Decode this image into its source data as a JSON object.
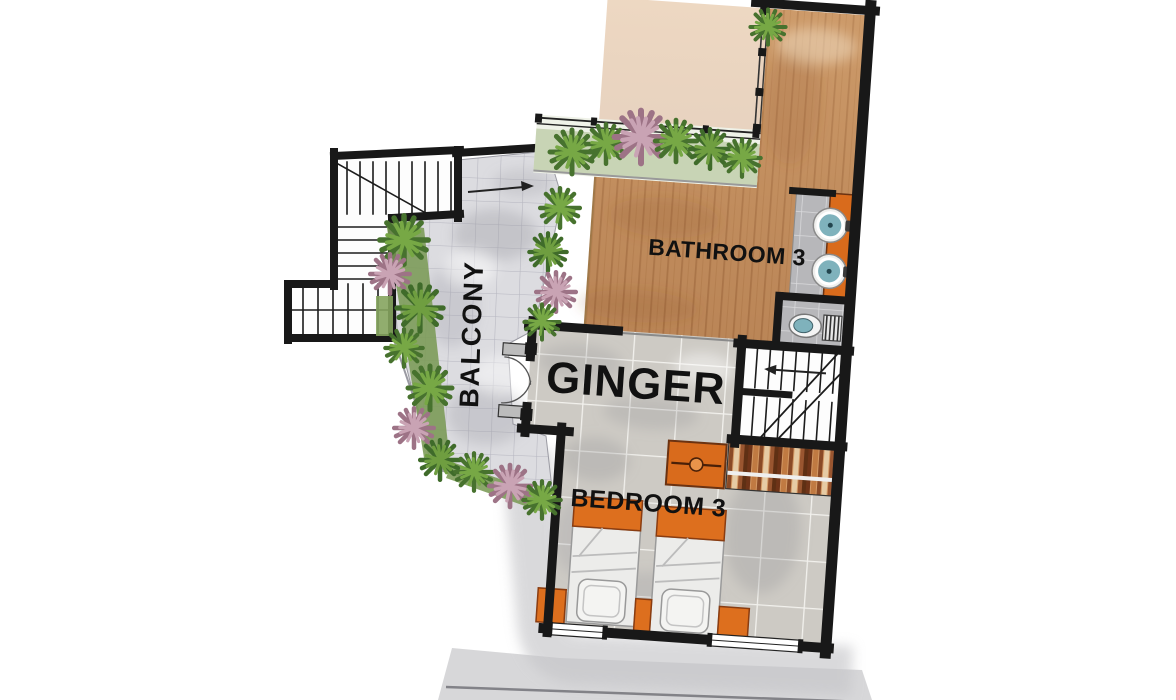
{
  "floorplan": {
    "unit_name": "GINGER",
    "labels": {
      "bathroom": "BATHROOM 3",
      "unit": "GINGER",
      "bedroom": "BEDROOM 3",
      "balcony": "BALCONY"
    },
    "colors": {
      "wall": "#1a1a1a",
      "wood_deck": "#c4905f",
      "accent_orange": "#dd6f1e",
      "plant_green": "#5f9140",
      "plant_pink": "#bb8fa0",
      "balcony_tile": "#dcdce0",
      "room_tile": "#cdcac4",
      "sink_teal": "#7fb2bc"
    },
    "features": [
      "external-staircase",
      "internal-staircase",
      "planter-with-railing",
      "balcony-double-doors",
      "vanity-two-sinks",
      "toilet",
      "wardrobe-rail",
      "dresser",
      "twin-beds",
      "nightstands",
      "windows"
    ]
  }
}
